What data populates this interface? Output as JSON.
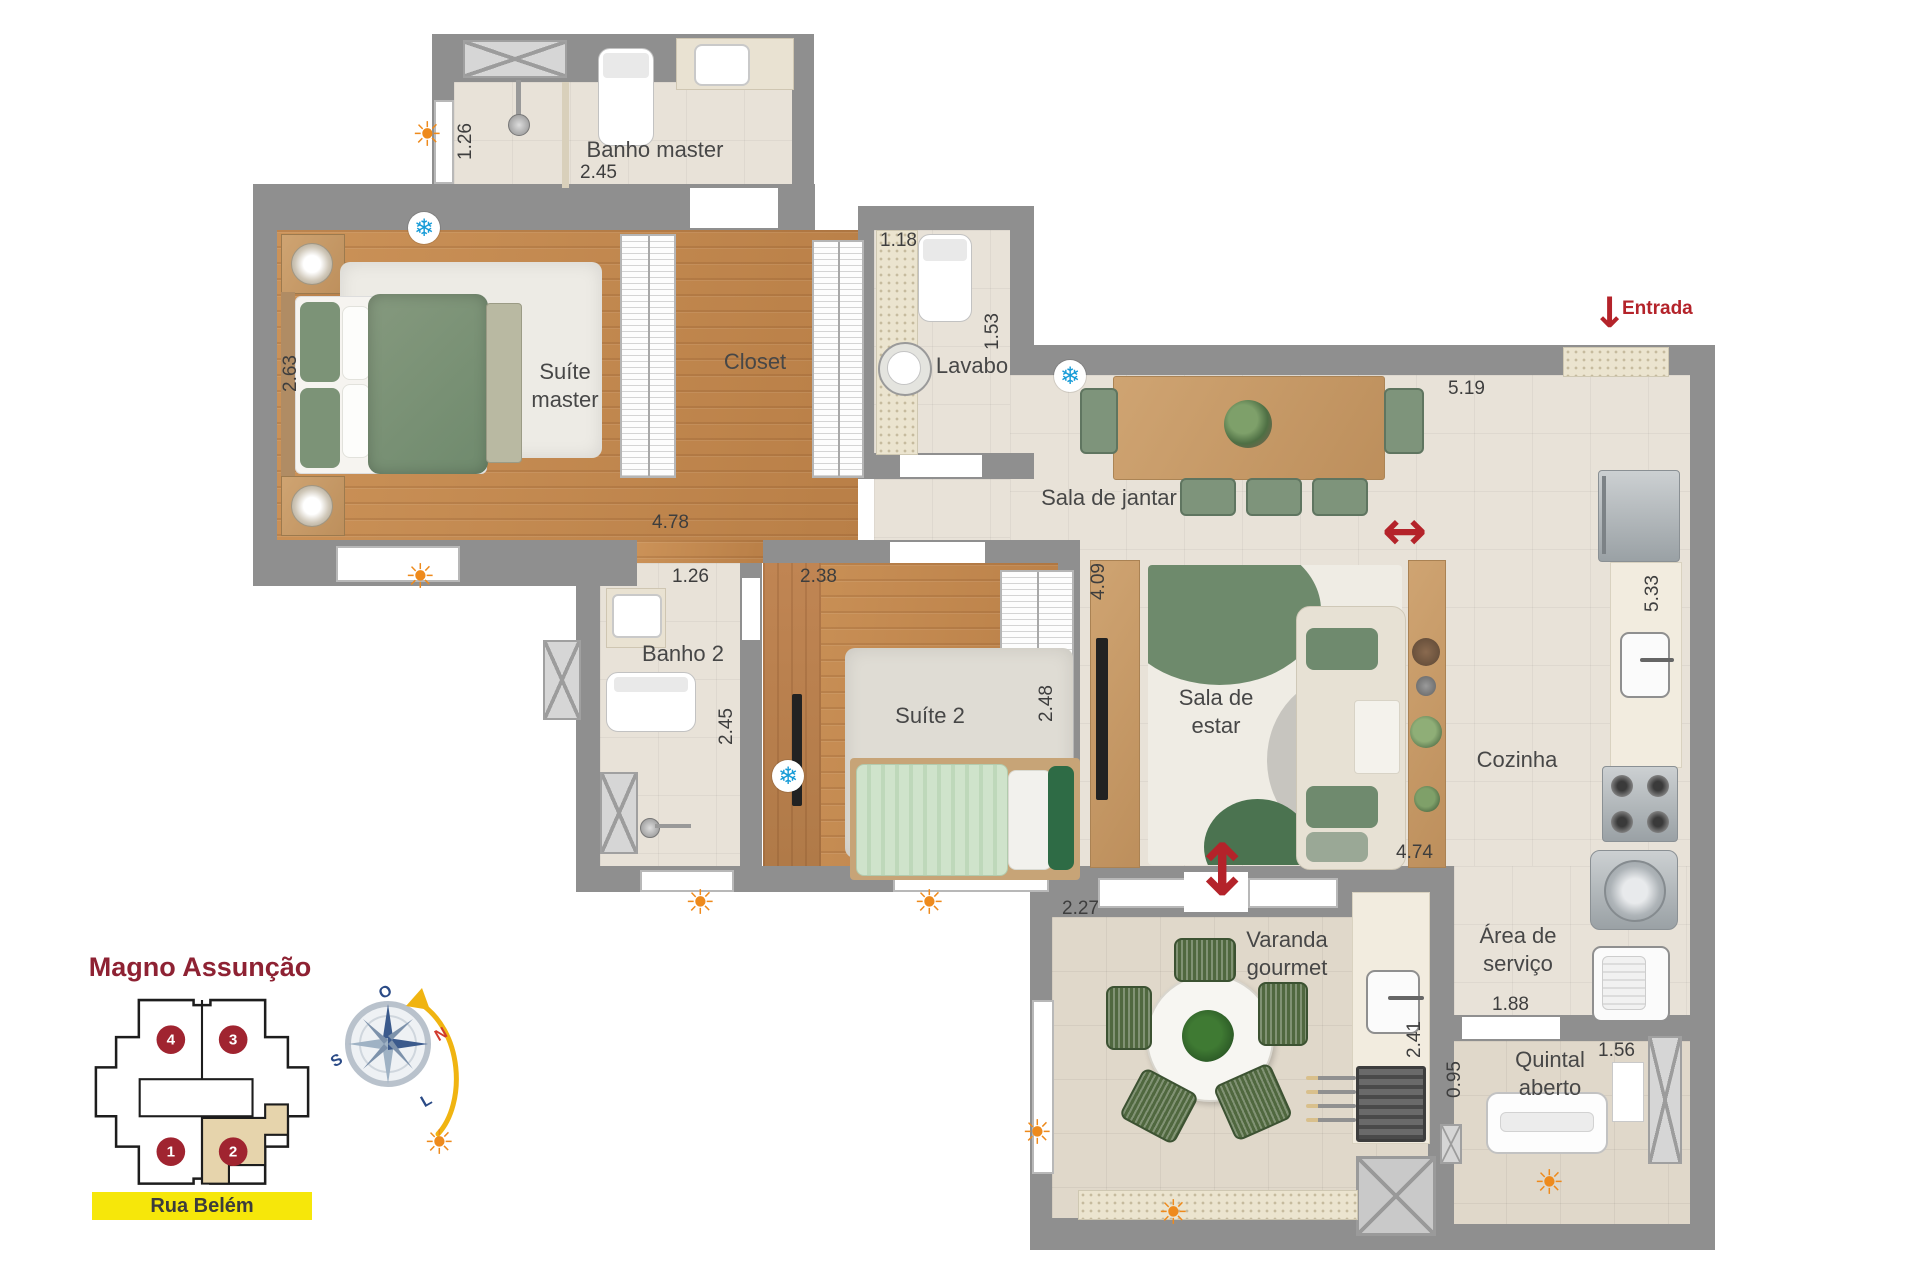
{
  "labels": {
    "banho_master": "Banho master",
    "suite_master": "Suíte master",
    "closet": "Closet",
    "lavabo": "Lavabo",
    "sala_jantar": "Sala de jantar",
    "sala_estar": "Sala de estar",
    "cozinha": "Cozinha",
    "suite2": "Suíte 2",
    "banho2": "Banho 2",
    "varanda": "Varanda gourmet",
    "area_servico": "Área de serviço",
    "quintal": "Quintal aberto",
    "entrada": "Entrada"
  },
  "dims": {
    "banho_master_h": "1.26",
    "banho_master_w": "2.45",
    "suite_master_bed": "2.63",
    "suite_master_w": "4.78",
    "lavabo_w": "1.18",
    "lavabo_h": "1.53",
    "jantar_w": "5.19",
    "estar_h": "4.09",
    "estar_w": "4.74",
    "cozinha_h": "5.33",
    "banho2_w": "1.26",
    "banho2_h": "2.45",
    "suite2_w": "2.38",
    "suite2_h": "2.48",
    "varanda_w": "2.27",
    "varanda_h": "2.41",
    "servico_w": "1.88",
    "quintal_h": "0.95",
    "quintal_w": "1.56"
  },
  "keyplan": {
    "title": "Magno Assunção",
    "street": "Rua Belém",
    "units": [
      "1",
      "2",
      "3",
      "4"
    ],
    "highlighted_unit": "2"
  },
  "compass": {
    "n": "N",
    "s": "S",
    "l": "L",
    "o": "O"
  },
  "icons": {
    "sun": "☀",
    "snowflake": "❄",
    "arrow_h": "↔",
    "arrow_v": "↕",
    "arrow_down": "↓"
  },
  "colors": {
    "accent_red": "#b4232a",
    "highlight_yellow": "#f6e70a",
    "wall_gray": "#8f8f8f",
    "unit_highlight": "#e6d4ac"
  }
}
